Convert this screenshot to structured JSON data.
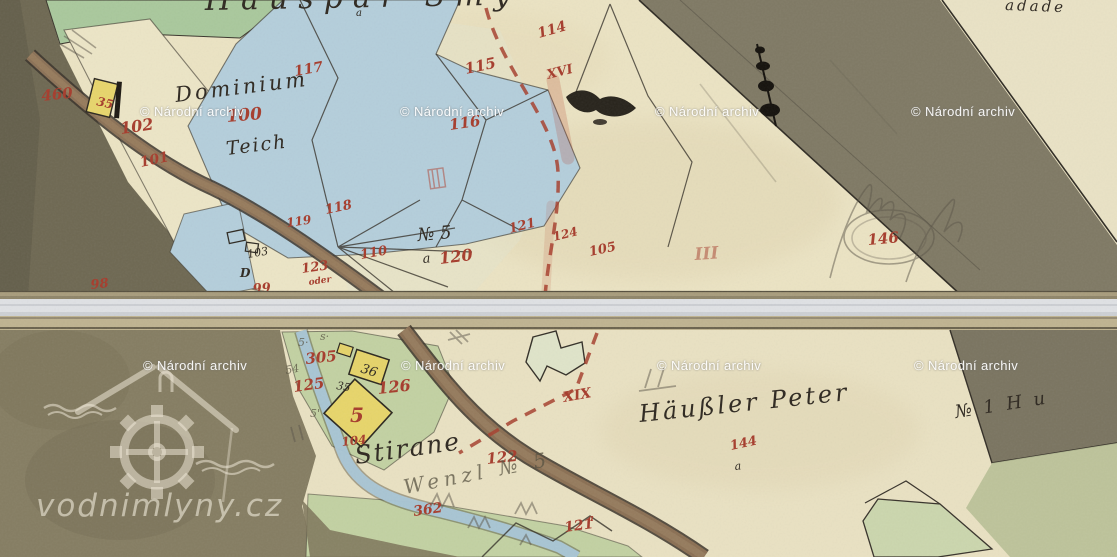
{
  "source": {
    "archive_watermark": "© Národní archiv",
    "site_watermark": "vodnimlyny.cz"
  },
  "sheet_top": {
    "title_fragment": "Häuspar Smÿ",
    "corner_fragment": "adade",
    "place_labels": {
      "dominium": "Dominium",
      "teich": "Teich",
      "no5": "№ 5",
      "a_under_no5": "a",
      "d_letter": "D",
      "a_small": "a"
    },
    "parcel_numbers": {
      "n460": "460",
      "n35": "35",
      "n102": "102",
      "n101": "101",
      "n100": "100",
      "n117": "117",
      "n114": "114",
      "n115": "115",
      "xvi": "XVI",
      "n116": "116",
      "n118": "118",
      "n119": "119",
      "n110": "110",
      "n123": "123",
      "oder": "oder",
      "n99": "99",
      "n98": "98",
      "n103": "103",
      "n121": "121",
      "n124": "124",
      "n105": "105",
      "n120": "120",
      "n146": "146",
      "roman_iii": "III"
    }
  },
  "sheet_bottom": {
    "place_labels": {
      "stirane": "Stirane",
      "wenzl": "Wenzl № 5",
      "hausler": "Häußler Peter",
      "no1": "№ 1 H u"
    },
    "parcel_numbers": {
      "n305": "305",
      "n125": "125",
      "n126": "126",
      "n36": "36",
      "n5": "5",
      "n35": "35",
      "n104": "104",
      "n122": "122",
      "n362": "362",
      "n121": "121",
      "sup_a": "a",
      "xix": "XIX",
      "n144": "144",
      "a_small": "a"
    },
    "pencil_marks": {
      "m54": "54",
      "m5": "5·",
      "ms": "s·",
      "m5b": "5'"
    }
  }
}
